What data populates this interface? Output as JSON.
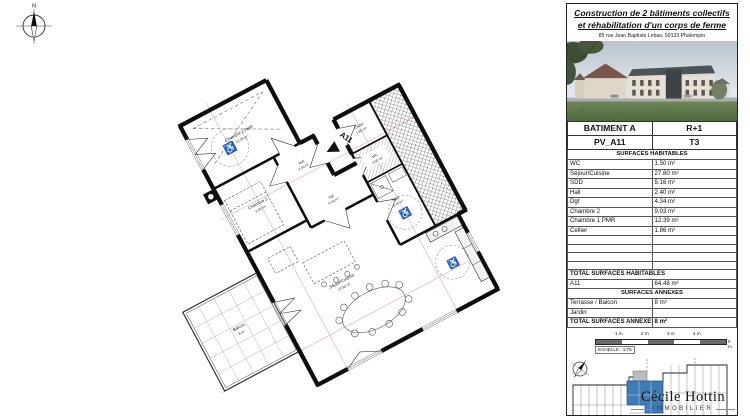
{
  "compass": {
    "label": "N"
  },
  "panel": {
    "title_line1": "Construction de 2 bâtiments collectifs",
    "title_line2": "et réhabilitation d'un corps de ferme",
    "address": "85 rue Jean Baptiste Lebas, 59133 Phalempin",
    "building_table": {
      "batiment": "BATIMENT A",
      "etage": "R+1",
      "lot": "PV_A11",
      "type": "T3"
    },
    "surfaces_habitables": {
      "section_title": "SURFACES HABITABLES",
      "rows": [
        {
          "label": "WC",
          "value": "1.50 m²"
        },
        {
          "label": "Séjour/Cuisine",
          "value": "27.80 m²"
        },
        {
          "label": "SDD",
          "value": "5.16 m²"
        },
        {
          "label": "Hall",
          "value": "2.40 m²"
        },
        {
          "label": "Dgt",
          "value": "4.34 m²"
        },
        {
          "label": "Chambre 2",
          "value": "9.03 m²"
        },
        {
          "label": "Chambre 1 PMR",
          "value": "12.39 m²"
        },
        {
          "label": "Cellier",
          "value": "1.86 m²"
        }
      ],
      "total_label": "TOTAL SURFACES HABITABLES",
      "total_lot": "A11",
      "total_value": "64.48 m²"
    },
    "surfaces_annexes": {
      "section_title": "SURFACES ANNEXES",
      "rows": [
        {
          "label": "Terrasse / Balcon",
          "value": "8 m²"
        },
        {
          "label": "Jardin",
          "value": ""
        }
      ],
      "total_label": "TOTAL SURFACES ANNEXES",
      "total_value": "8 m²"
    },
    "scale_bar": {
      "ticks": [
        "1 m",
        "2 m",
        "3 m",
        "4 m",
        "5 m"
      ],
      "echelle": "ECHELLE : 1/75"
    },
    "logo": {
      "name": "Cécile Hottin",
      "tagline": "IMMOBILIER"
    },
    "colors": {
      "highlight_blue": "#3f7cb6",
      "roof_gray": "#4e5356",
      "lawn_green": "#5f7c4c"
    }
  },
  "floorplan": {
    "unit_label": "A11",
    "rooms": [
      {
        "name": "Chambre 1 PMR",
        "area": "12.39 m²"
      },
      {
        "name": "Chambre 2",
        "area": "9.03 m²"
      },
      {
        "name": "Hall",
        "area": "2.40 m²"
      },
      {
        "name": "Dgt",
        "area": "4.34 m²"
      },
      {
        "name": "Cellier",
        "area": "1.86 m²"
      },
      {
        "name": "WC",
        "area": "1.50 m²"
      },
      {
        "name": "SDD",
        "area": "5.16 m²"
      },
      {
        "name": "Séjour/Cuisine",
        "area": "27.80 m²"
      },
      {
        "name": "Balcon",
        "area": "8 m²"
      }
    ]
  }
}
